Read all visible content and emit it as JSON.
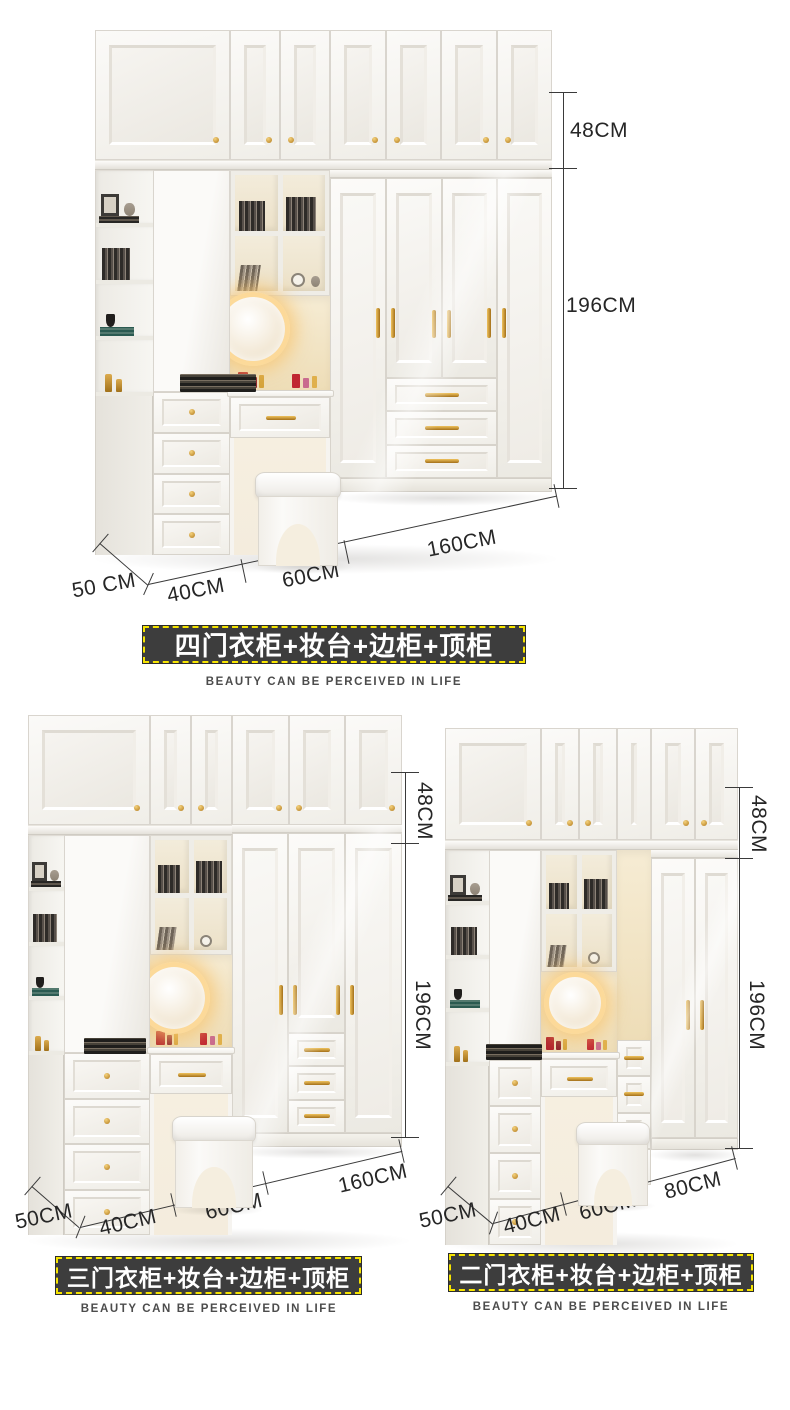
{
  "page": {
    "background": "#ffffff"
  },
  "colors": {
    "badge_background": "#3d3d3d",
    "badge_dashed_border": "#f6e400",
    "badge_text": "#ffffff",
    "dimension_line": "#3a3a3a",
    "gold_hardware": "#c8922f",
    "cabinet_white": "#f6f5f2",
    "vanity_warm_glow": "#f3e3c2"
  },
  "products": [
    {
      "id": "four-door",
      "title": "四门衣柜+妆台+边柜+顶柜",
      "tagline": "BEAUTY CAN BE PERCEIVED IN LIFE",
      "dims": {
        "top": "48CM",
        "height": "196CM",
        "wardrobe": "160CM",
        "vanity": "60CM",
        "drawers": "40CM",
        "depth": "50 CM"
      }
    },
    {
      "id": "three-door",
      "title": "三门衣柜+妆台+边柜+顶柜",
      "tagline": "BEAUTY CAN BE PERCEIVED IN LIFE",
      "dims": {
        "top": "48CM",
        "height": "196CM",
        "wardrobe": "160CM",
        "vanity": "60CM",
        "drawers": "40CM",
        "depth": "50CM"
      }
    },
    {
      "id": "two-door",
      "title": "二门衣柜+妆台+边柜+顶柜",
      "tagline": "BEAUTY CAN BE PERCEIVED IN LIFE",
      "dims": {
        "top": "48CM",
        "height": "196CM",
        "wardrobe": "80CM",
        "vanity": "60CM",
        "drawers": "40CM",
        "depth": "50CM"
      }
    }
  ]
}
